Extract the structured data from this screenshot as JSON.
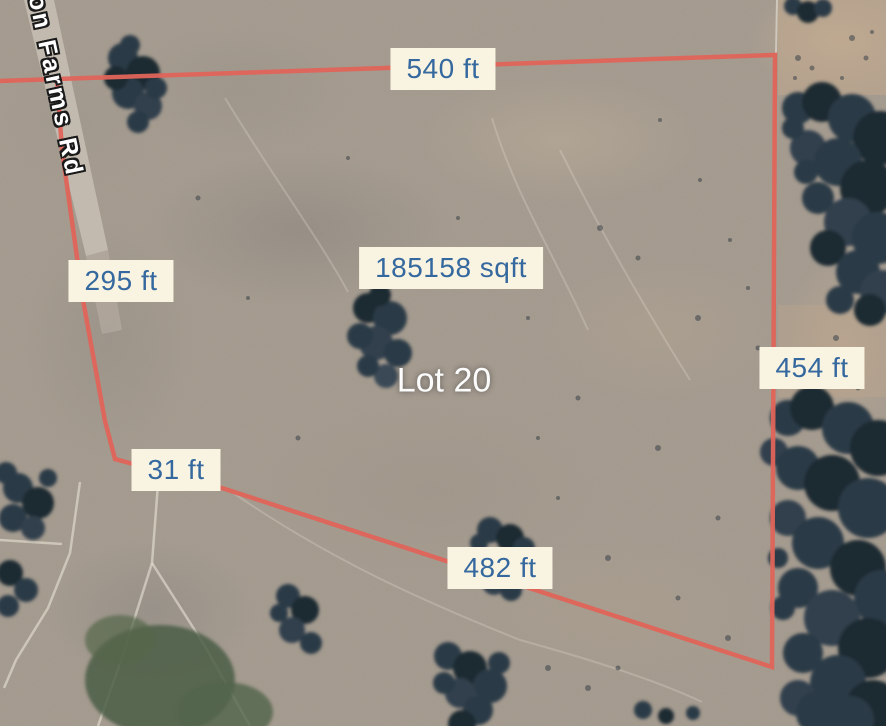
{
  "map": {
    "road_label": "on Farms Rd",
    "lot": {
      "name": "Lot 20",
      "area": "185158 sqft"
    },
    "measurements": {
      "top": "540 ft",
      "left": "295 ft",
      "right": "454 ft",
      "bottom_short": "31 ft",
      "bottom": "482 ft"
    },
    "colors": {
      "boundary": "#e0645a",
      "label_bg": "#f9f4e1",
      "label_text": "#34689e",
      "lot_text": "#fcfcfc",
      "road_text": "#ffffff"
    }
  }
}
